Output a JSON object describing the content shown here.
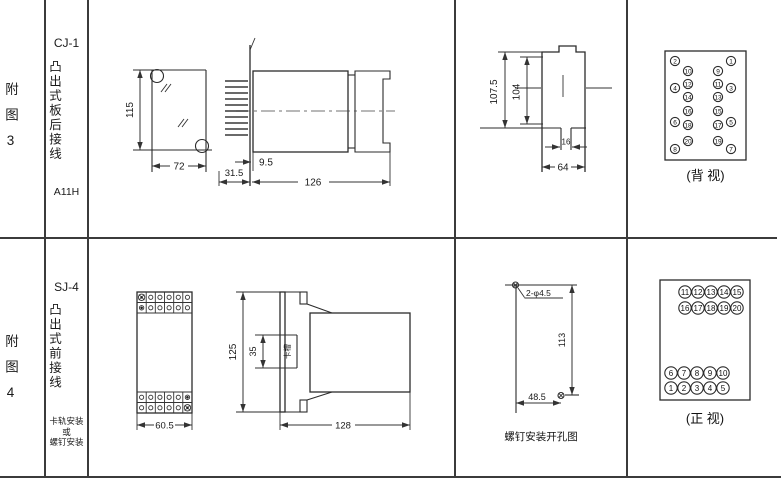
{
  "row1": {
    "figure_label": "附图3",
    "model": "CJ-1",
    "mount_type": "凸出式板后接线",
    "code": "A11H",
    "plate_view": {
      "height": "115",
      "width": "72"
    },
    "side_view": {
      "pin_depth": "31.5",
      "panel_offset": "9.5",
      "body_length": "126"
    },
    "cutout_view": {
      "outer_height": "107.5",
      "inner_height": "104",
      "stem_width": "16",
      "width": "64"
    },
    "terminal_view": {
      "caption": "(背 视)",
      "pins": [
        {
          "n": "2",
          "x": 48,
          "y": 61
        },
        {
          "n": "1",
          "x": 104,
          "y": 61
        },
        {
          "n": "10",
          "x": 61,
          "y": 71
        },
        {
          "n": "9",
          "x": 91,
          "y": 71
        },
        {
          "n": "12",
          "x": 61,
          "y": 84
        },
        {
          "n": "11",
          "x": 91,
          "y": 84
        },
        {
          "n": "4",
          "x": 48,
          "y": 88
        },
        {
          "n": "3",
          "x": 104,
          "y": 88
        },
        {
          "n": "14",
          "x": 61,
          "y": 97
        },
        {
          "n": "13",
          "x": 91,
          "y": 97
        },
        {
          "n": "16",
          "x": 61,
          "y": 111
        },
        {
          "n": "15",
          "x": 91,
          "y": 111
        },
        {
          "n": "6",
          "x": 48,
          "y": 122
        },
        {
          "n": "5",
          "x": 104,
          "y": 122
        },
        {
          "n": "18",
          "x": 61,
          "y": 125
        },
        {
          "n": "17",
          "x": 91,
          "y": 125
        },
        {
          "n": "20",
          "x": 61,
          "y": 141
        },
        {
          "n": "19",
          "x": 91,
          "y": 141
        },
        {
          "n": "8",
          "x": 48,
          "y": 149
        },
        {
          "n": "7",
          "x": 104,
          "y": 149
        }
      ]
    }
  },
  "row2": {
    "figure_label": "附图4",
    "model": "SJ-4",
    "mount_type": "凸出式前接线",
    "mount_notes": [
      "卡轨安装",
      "或",
      "螺钉安装"
    ],
    "front_view": {
      "width": "60.5"
    },
    "side_view": {
      "height": "125",
      "slot_height": "35",
      "slot_label": "卡槽",
      "body_length": "128"
    },
    "hole_view": {
      "hole_spec": "2-φ4.5",
      "vertical": "113",
      "horizontal": "48.5",
      "caption": "螺钉安装开孔图"
    },
    "terminal_view": {
      "caption": "(正 视)",
      "pins": [
        {
          "n": "11",
          "x": 58,
          "y": 55
        },
        {
          "n": "12",
          "x": 71,
          "y": 55
        },
        {
          "n": "13",
          "x": 84,
          "y": 55
        },
        {
          "n": "14",
          "x": 97,
          "y": 55
        },
        {
          "n": "15",
          "x": 110,
          "y": 55
        },
        {
          "n": "16",
          "x": 58,
          "y": 71
        },
        {
          "n": "17",
          "x": 71,
          "y": 71
        },
        {
          "n": "18",
          "x": 84,
          "y": 71
        },
        {
          "n": "19",
          "x": 97,
          "y": 71
        },
        {
          "n": "20",
          "x": 110,
          "y": 71
        },
        {
          "n": "6",
          "x": 44,
          "y": 136
        },
        {
          "n": "7",
          "x": 57,
          "y": 136
        },
        {
          "n": "8",
          "x": 70,
          "y": 136
        },
        {
          "n": "9",
          "x": 83,
          "y": 136
        },
        {
          "n": "10",
          "x": 96,
          "y": 136
        },
        {
          "n": "1",
          "x": 44,
          "y": 151
        },
        {
          "n": "2",
          "x": 57,
          "y": 151
        },
        {
          "n": "3",
          "x": 70,
          "y": 151
        },
        {
          "n": "4",
          "x": 83,
          "y": 151
        },
        {
          "n": "5",
          "x": 96,
          "y": 151
        }
      ]
    }
  }
}
